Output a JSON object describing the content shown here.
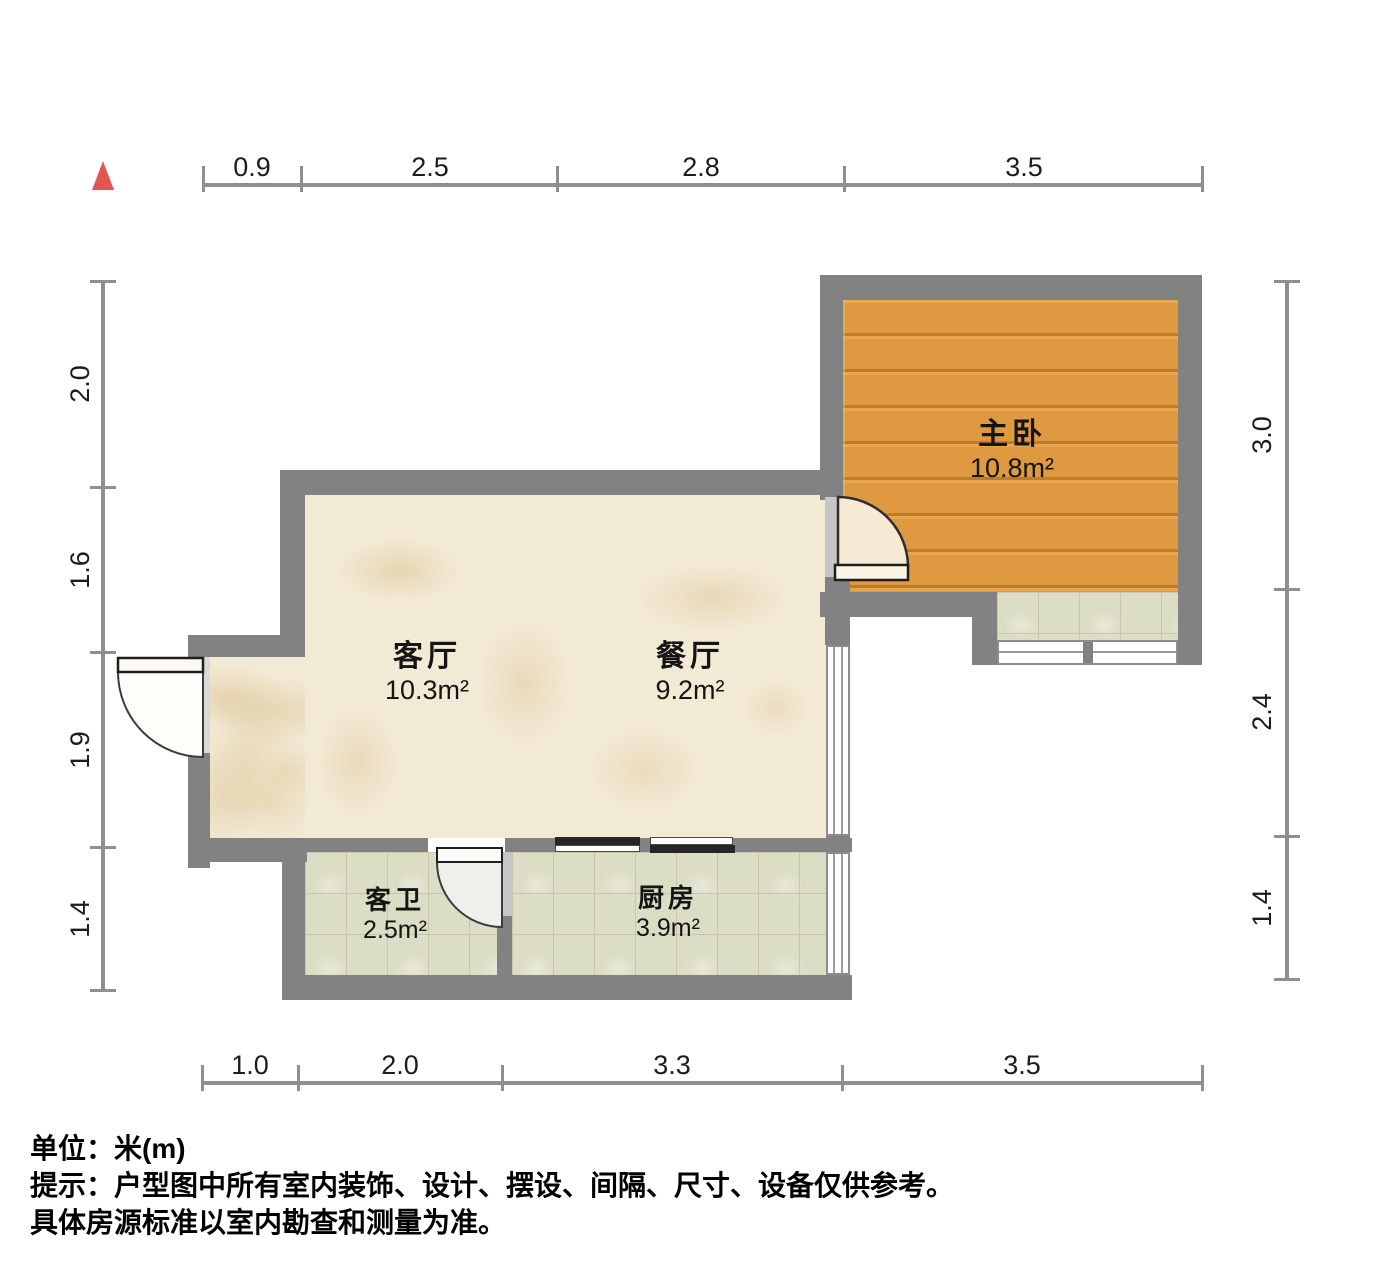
{
  "plan": {
    "type": "apartment-floorplan",
    "compass": "north-indicator",
    "colors": {
      "wall": "#828282",
      "wood_floor": "#e09a42",
      "marble_floor": "#f3ead6",
      "tile_floor": "#dcddc5",
      "north_marker": "#e25555",
      "dim_line": "#8f8f8f",
      "sliding_panel": "#262626"
    }
  },
  "rooms": {
    "bedroom": {
      "name": "主卧",
      "area": "10.8m²"
    },
    "living": {
      "name": "客厅",
      "area": "10.3m²"
    },
    "dining": {
      "name": "餐厅",
      "area": "9.2m²"
    },
    "bathroom": {
      "name": "客卫",
      "area": "2.5m²"
    },
    "kitchen": {
      "name": "厨房",
      "area": "3.9m²"
    }
  },
  "dimensions": {
    "unit": "m",
    "top": [
      "0.9",
      "2.5",
      "2.8",
      "3.5"
    ],
    "left": [
      "2.0",
      "1.6",
      "1.9",
      "1.4"
    ],
    "right": [
      "3.0",
      "2.4",
      "1.4"
    ],
    "bottom": [
      "1.0",
      "2.0",
      "3.3",
      "3.5"
    ]
  },
  "footer": {
    "unit_label": "单位：",
    "unit_value": "米(m)",
    "tip_line1": "提示：户型图中所有室内装饰、设计、摆设、间隔、尺寸、设备仅供参考。",
    "tip_line2": "具体房源标准以室内勘查和测量为准。"
  }
}
